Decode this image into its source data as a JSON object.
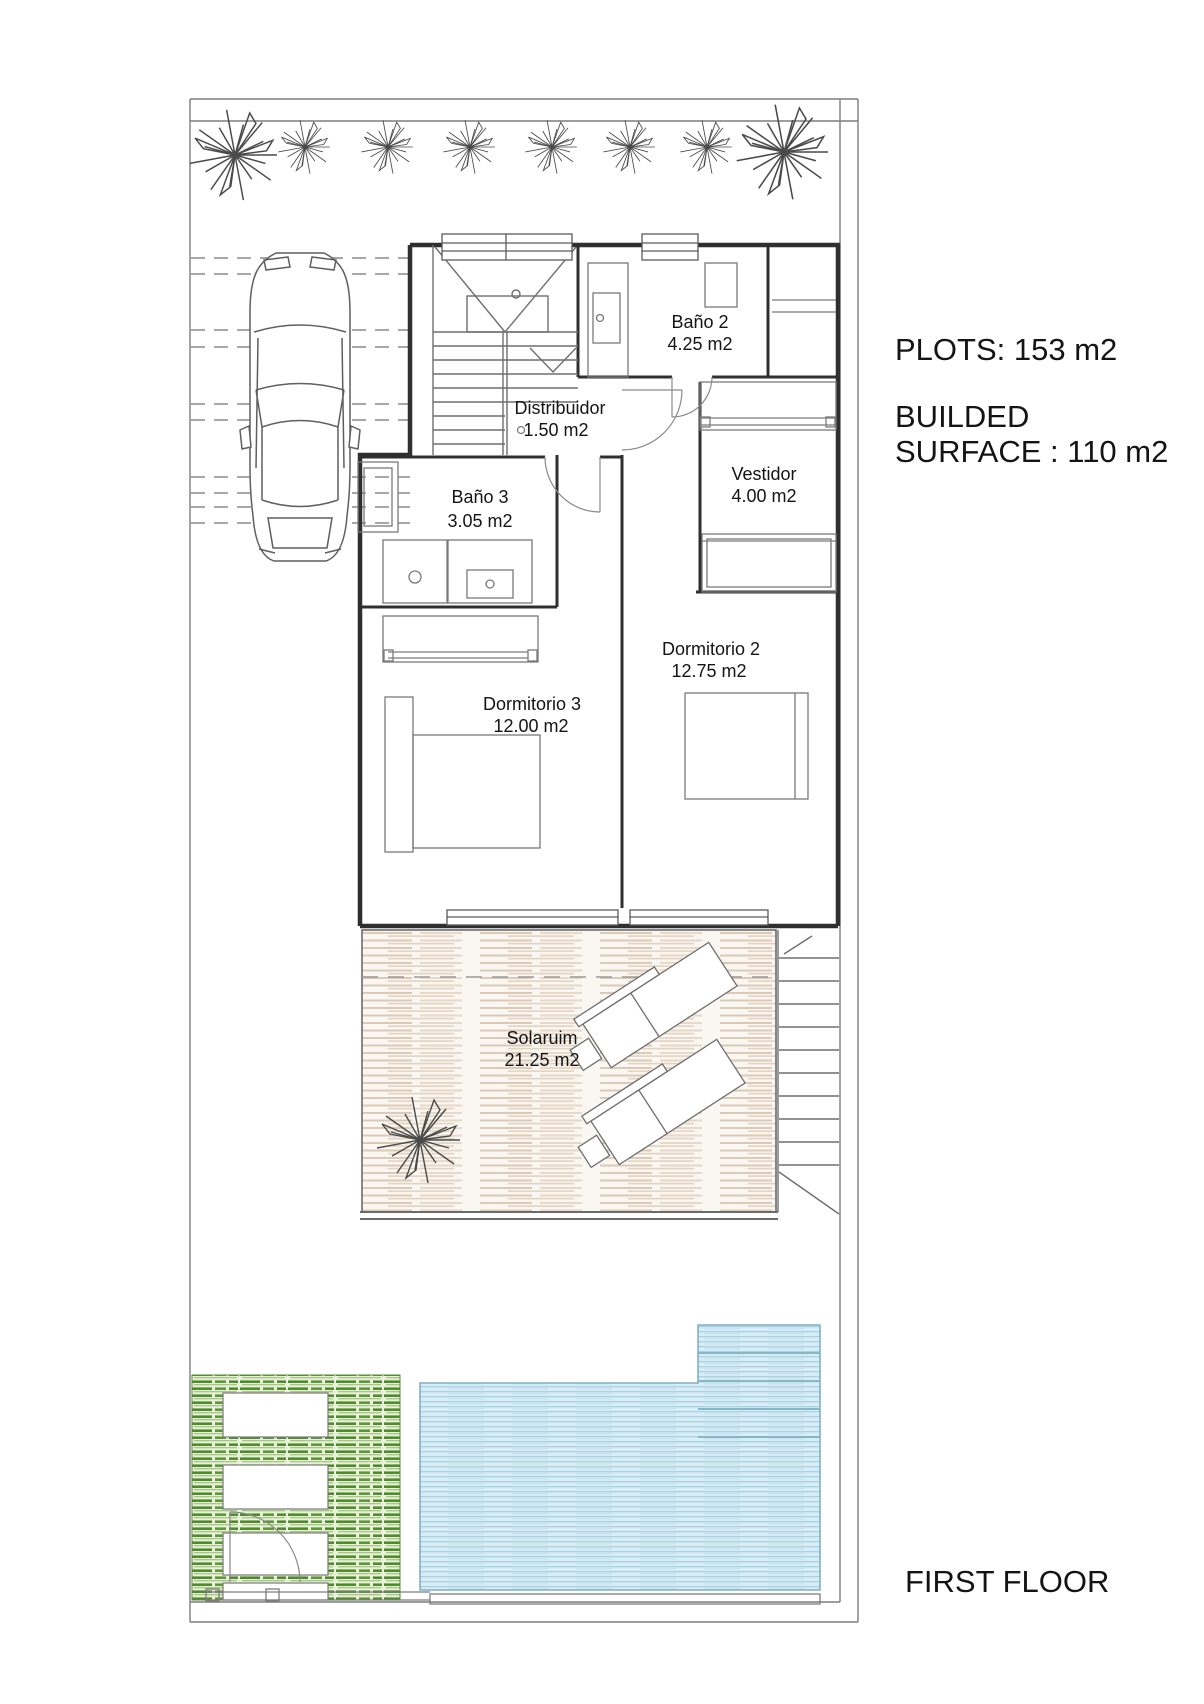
{
  "annotations": {
    "plots": "PLOTS: 153 m2",
    "builded_line1": "BUILDED",
    "builded_line2": "SURFACE : 110 m2",
    "floor_label": "FIRST FLOOR"
  },
  "rooms": [
    {
      "id": "bano2",
      "name": "Baño 2",
      "area": "4.25 m2"
    },
    {
      "id": "distribuidor",
      "name": "Distribuidor",
      "area": "1.50 m2"
    },
    {
      "id": "bano3",
      "name": "Baño 3",
      "area": "3.05 m2"
    },
    {
      "id": "vestidor",
      "name": "Vestidor",
      "area": "4.00 m2"
    },
    {
      "id": "dormitorio2",
      "name": "Dormitorio 2",
      "area": "12.75 m2"
    },
    {
      "id": "dormitorio3",
      "name": "Dormitorio 3",
      "area": "12.00 m2"
    },
    {
      "id": "solarium",
      "name": "Solaruim",
      "area": "21.25 m2"
    }
  ],
  "colors": {
    "wall": "#2f2f2f",
    "deck_stripe": "#d9c6b4",
    "lawn_stripe": "#4f8a2e",
    "pool_water": "#a9d2e2"
  }
}
